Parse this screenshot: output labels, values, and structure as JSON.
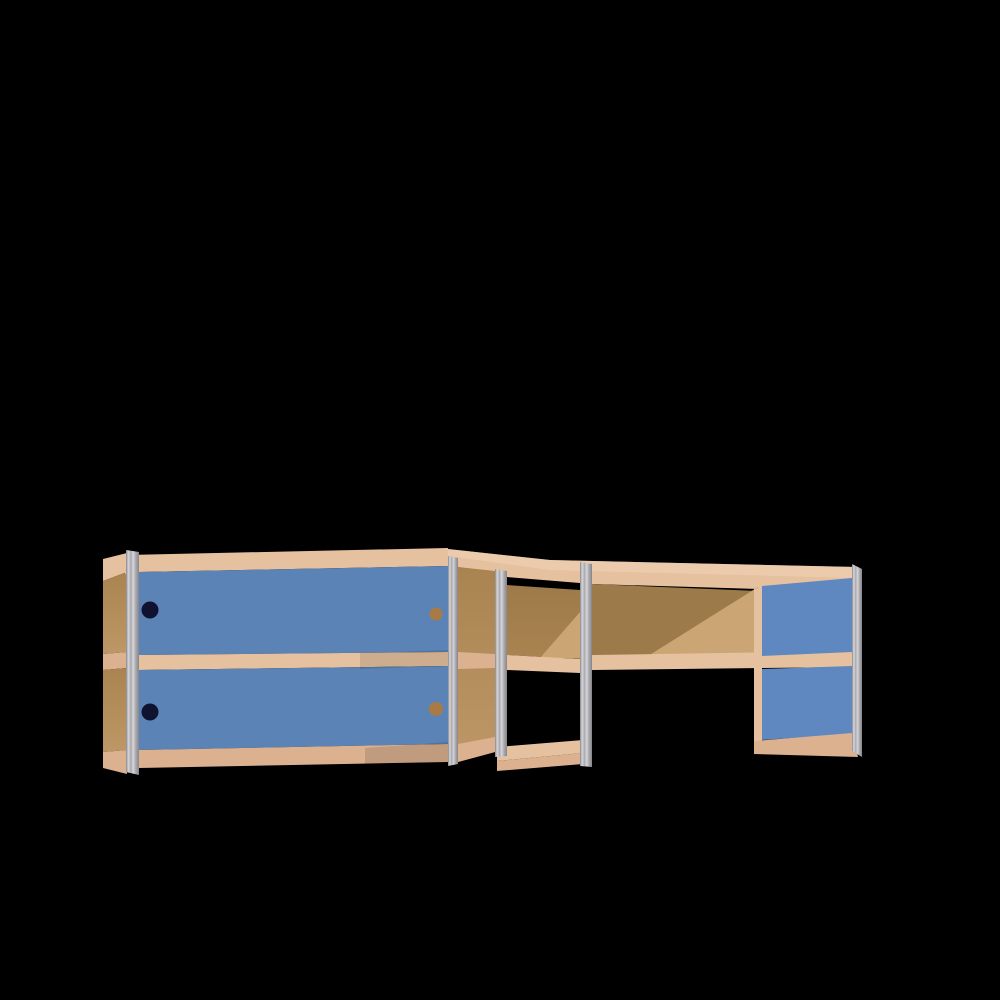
{
  "scene": {
    "description": "3D render of an L-shaped wall cabinet: plywood carcass with blue sliding-door fronts, aluminium edge profiles, open corner and open right compartment, on a black background",
    "background": "#000000"
  },
  "colors": {
    "background": "#000000",
    "wood_light": "#e6c1a0",
    "wood_highlight": "#f1d4b6",
    "wood_mid": "#dcb190",
    "panel_dark": "#a98450",
    "panel_mid": "#bd9765",
    "back_dark": "#9d7a49",
    "back_light": "#cba674",
    "door_blue": "#5b83b6",
    "door_blue_right": "#5e88bf",
    "alu_dark": "#85858a",
    "alu_mid": "#aaaaae",
    "alu_light": "#d7d7db",
    "handle_navy": "#0f1330",
    "handle_bronze": "#a87a45",
    "shadow": "#000000"
  },
  "furniture": {
    "left_section": {
      "blue_doors_visible": 2,
      "handles_visible": 4,
      "handle_colors": [
        "navy",
        "navy",
        "bronze",
        "bronze"
      ]
    },
    "corner_section": {
      "open_bottom": true,
      "back_panel_visible": true
    },
    "right_section": {
      "open_compartment": true,
      "blue_panels_visible": 2
    }
  }
}
